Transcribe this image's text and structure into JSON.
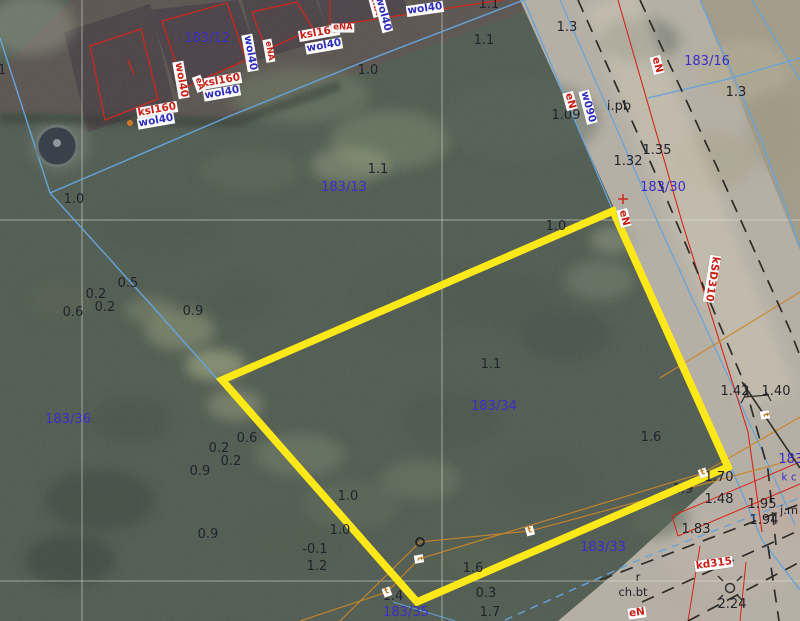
{
  "app": {
    "type": "cadastral-map-view"
  },
  "palette": {
    "num": "#22242c",
    "parcel": "#3a2ec8",
    "red": "#cc1f14",
    "blue": "#2d2ec0",
    "orange": "#c87820",
    "line_blue": "#66a3da",
    "line_red": "#d2261a",
    "line_orange": "#c8862a",
    "line_black": "#2e2c28",
    "grid": "#e3e6de",
    "highlight": "#ffe818"
  },
  "highlight_parcel": {
    "id": "183/34",
    "points": "613,211 222,380 417,602 728,467",
    "stroke_width": 7.5
  },
  "grid": {
    "v": [
      82,
      442
    ],
    "h": [
      220,
      581
    ]
  },
  "regions": [
    {
      "name": "pavement-top-left",
      "pts": "70,0 556,0 232,118 0,112 0,72",
      "fill": "#59534f"
    },
    {
      "name": "road-main",
      "pts": "520,0 700,0 800,250 800,621 558,621 616,572 731,467",
      "fill": "#b4aea4"
    },
    {
      "name": "parcel-183-16-surface",
      "pts": "700,0 800,0 800,250",
      "fill": "#a19a87"
    },
    {
      "name": "building-roof",
      "pts": "64,32 150,4 174,104 88,132",
      "fill": "#4a4145"
    },
    {
      "name": "building-roof",
      "pts": "150,10 238,0 258,56 176,92",
      "fill": "#494046"
    },
    {
      "name": "building-roof",
      "pts": "242,0 316,0 330,38 258,60",
      "fill": "#4a4145"
    },
    {
      "name": "building-roof",
      "pts": "318,0 404,0 410,14 326,28",
      "fill": "#4b4247"
    }
  ],
  "building_outlines": [
    {
      "name": "building-outline",
      "pts": "90,46 141,29 158,99 105,120"
    },
    {
      "name": "building-outline",
      "pts": "162,21 227,3 246,60 184,88"
    },
    {
      "name": "building-outline",
      "pts": "252,12 297,2 313,29 266,50"
    }
  ],
  "lines": [
    {
      "name": "water-line",
      "pts": "0,38 50,193",
      "c": "line_blue",
      "w": 1.4
    },
    {
      "name": "water-line",
      "pts": "50,193 153,307 218,380",
      "c": "line_blue",
      "w": 1.4
    },
    {
      "name": "water-line",
      "pts": "50,193 230,116 368,60 524,0",
      "c": "line_blue",
      "w": 1.4
    },
    {
      "name": "boundary-line-blue",
      "pts": "524,0 613,211 731,467 762,540 800,590",
      "c": "line_blue",
      "w": 1.3
    },
    {
      "name": "boundary-line-blue",
      "pts": "560,0 662,232 764,455 795,525",
      "c": "line_blue",
      "w": 1.2
    },
    {
      "name": "boundary-line-blue",
      "pts": "700,0 762,142 800,247",
      "c": "line_blue",
      "w": 1.3
    },
    {
      "name": "boundary-line-blue",
      "pts": "648,98 728,79 800,58",
      "c": "line_blue",
      "w": 1.2
    },
    {
      "name": "boundary-line-blue",
      "pts": "752,0 800,80",
      "c": "line_blue",
      "w": 1.2
    },
    {
      "name": "water-line-dashed",
      "pts": "505,620 648,556 800,498",
      "c": "line_blue",
      "w": 1.4,
      "dash": "8,6"
    },
    {
      "name": "boundary-line-blue",
      "pts": "393,602 455,621",
      "c": "line_blue",
      "w": 1
    },
    {
      "name": "power-line",
      "pts": "330,0 330,26",
      "c": "line_red",
      "w": 1.2
    },
    {
      "name": "power-line",
      "pts": "330,26 502,0",
      "c": "line_red",
      "w": 1.2
    },
    {
      "name": "power-line",
      "pts": "618,0 682,222 748,432 762,532",
      "c": "line_red",
      "w": 1.1
    },
    {
      "name": "red-outline",
      "pts": "672,516 800,462",
      "c": "line_red",
      "w": 1
    },
    {
      "name": "red-outline",
      "pts": "678,536 800,484",
      "c": "line_red",
      "w": 1
    },
    {
      "name": "red-outline",
      "pts": "672,516 678,536",
      "c": "line_red",
      "w": 1
    },
    {
      "name": "red-outline",
      "pts": "700,546 688,621",
      "c": "line_red",
      "w": 1
    },
    {
      "name": "red-outline",
      "pts": "746,562 740,621",
      "c": "line_red",
      "w": 1
    },
    {
      "name": "roof-mark",
      "pts": "128,60 134,74",
      "c": "line_red",
      "w": 1.3
    },
    {
      "name": "telecom-line",
      "pts": "340,621 420,542 530,531 800,458",
      "c": "line_orange",
      "w": 1.1
    },
    {
      "name": "telecom-line",
      "pts": "300,621 387,592 419,559 703,473 800,417",
      "c": "line_orange",
      "w": 1.1
    },
    {
      "name": "telecom-line",
      "pts": "660,378 800,292",
      "c": "line_orange",
      "w": 1.1
    },
    {
      "name": "road-edge-dashed",
      "pts": "578,0 665,195 745,385 768,470 776,545",
      "c": "line_black",
      "w": 1.7,
      "dash": "13,9"
    },
    {
      "name": "road-edge-dashed",
      "pts": "640,0 716,165 790,330 800,356",
      "c": "line_black",
      "w": 1.7,
      "dash": "13,9"
    },
    {
      "name": "road-edge-dashed",
      "pts": "600,580 800,504",
      "c": "line_black",
      "w": 1.7,
      "dash": "13,9"
    },
    {
      "name": "road-edge-dashed",
      "pts": "642,602 800,530",
      "c": "line_black",
      "w": 1.7,
      "dash": "13,9"
    },
    {
      "name": "road-edge-dashed",
      "pts": "688,621 800,562",
      "c": "line_black",
      "w": 1.7,
      "dash": "13,9"
    },
    {
      "name": "road-edge-dashed",
      "pts": "768,546 779,621",
      "c": "line_black",
      "w": 1.7,
      "dash": "13,9"
    },
    {
      "name": "boundary-line-black",
      "pts": "742,382 800,468",
      "c": "line_black",
      "w": 1.6
    },
    {
      "name": "dimension-tick",
      "pts": "741,403 747,392",
      "c": "line_black",
      "w": 1.2
    },
    {
      "name": "dimension-tick",
      "pts": "744,397 769,395",
      "c": "line_black",
      "w": 1.2
    },
    {
      "name": "dimension-tick",
      "pts": "765,390 771,401",
      "c": "line_black",
      "w": 1.2
    }
  ],
  "symbols": [
    {
      "type": "pond",
      "x": 57,
      "y": 146,
      "r": 20
    },
    {
      "type": "dot",
      "x": 130,
      "y": 123,
      "r": 3,
      "fill": "#d07828"
    },
    {
      "type": "open-circle",
      "x": 420,
      "y": 542,
      "r": 4
    },
    {
      "type": "manhole",
      "x": 730,
      "y": 588,
      "r": 4.5
    },
    {
      "type": "cross",
      "x": 623,
      "y": 199,
      "size": 5,
      "c": "#d2261a"
    }
  ],
  "parcel_labels": [
    {
      "t": "183/12",
      "x": 207,
      "y": 39
    },
    {
      "t": "183/13",
      "x": 344,
      "y": 188
    },
    {
      "t": "183/16",
      "x": 707,
      "y": 62
    },
    {
      "t": "183/30",
      "x": 663,
      "y": 188
    },
    {
      "t": "183/33",
      "x": 603,
      "y": 548
    },
    {
      "t": "183/34",
      "x": 494,
      "y": 407
    },
    {
      "t": "183/35",
      "x": 406,
      "y": 613
    },
    {
      "t": "183/36",
      "x": 68,
      "y": 420
    },
    {
      "t": "183/",
      "x": 793,
      "y": 460
    },
    {
      "t": "k c",
      "x": 789,
      "y": 478,
      "small": 1
    }
  ],
  "elevation_labels": [
    {
      "t": "1",
      "x": 2,
      "y": 71
    },
    {
      "t": "1.0",
      "x": 368,
      "y": 71
    },
    {
      "t": "1.1",
      "x": 484,
      "y": 41
    },
    {
      "t": "1.1",
      "x": 489,
      "y": 5
    },
    {
      "t": "1.3",
      "x": 567,
      "y": 28
    },
    {
      "t": "1.09",
      "x": 566,
      "y": 116
    },
    {
      "t": "i.pb",
      "x": 619,
      "y": 107
    },
    {
      "t": "1.32",
      "x": 628,
      "y": 162
    },
    {
      "t": "1.35",
      "x": 657,
      "y": 151
    },
    {
      "t": "1.3",
      "x": 736,
      "y": 93
    },
    {
      "t": "1.1",
      "x": 378,
      "y": 170
    },
    {
      "t": "1.0",
      "x": 74,
      "y": 200
    },
    {
      "t": "1.0",
      "x": 556,
      "y": 227
    },
    {
      "t": "0.5",
      "x": 128,
      "y": 284
    },
    {
      "t": "0.2",
      "x": 96,
      "y": 295
    },
    {
      "t": "0.2",
      "x": 105,
      "y": 308
    },
    {
      "t": "0.6",
      "x": 73,
      "y": 313
    },
    {
      "t": "0.9",
      "x": 193,
      "y": 312
    },
    {
      "t": "1.1",
      "x": 491,
      "y": 365
    },
    {
      "t": "1.6",
      "x": 651,
      "y": 438
    },
    {
      "t": "0.6",
      "x": 247,
      "y": 439
    },
    {
      "t": "0.2",
      "x": 219,
      "y": 449
    },
    {
      "t": "0.2",
      "x": 231,
      "y": 462
    },
    {
      "t": "0.9",
      "x": 200,
      "y": 472
    },
    {
      "t": "1.0",
      "x": 348,
      "y": 497
    },
    {
      "t": "1.0",
      "x": 340,
      "y": 531
    },
    {
      "t": "0.9",
      "x": 208,
      "y": 535
    },
    {
      "t": "-0.1",
      "x": 315,
      "y": 550
    },
    {
      "t": "1.2",
      "x": 317,
      "y": 567
    },
    {
      "t": "1.6",
      "x": 473,
      "y": 569
    },
    {
      "t": "0.3",
      "x": 486,
      "y": 594
    },
    {
      "t": "1.4",
      "x": 393,
      "y": 597
    },
    {
      "t": "1.7",
      "x": 490,
      "y": 613
    },
    {
      "t": "1.42",
      "x": 735,
      "y": 392
    },
    {
      "t": "1.40",
      "x": 776,
      "y": 392
    },
    {
      "t": "1.70",
      "x": 719,
      "y": 478
    },
    {
      "t": "1.9",
      "x": 683,
      "y": 489,
      "under": 1
    },
    {
      "t": "1.48",
      "x": 719,
      "y": 500
    },
    {
      "t": "1.95",
      "x": 762,
      "y": 505
    },
    {
      "t": "1.94",
      "x": 764,
      "y": 521
    },
    {
      "t": "1.83",
      "x": 696,
      "y": 530
    },
    {
      "t": "2.24",
      "x": 732,
      "y": 605
    },
    {
      "t": "r",
      "x": 638,
      "y": 577,
      "small": 1
    },
    {
      "t": "ch.bt",
      "x": 633,
      "y": 592,
      "small": 1
    },
    {
      "t": "j.m",
      "x": 789,
      "y": 510,
      "small": 1
    }
  ],
  "boxed_labels": [
    {
      "t": "ksl160",
      "x": 157,
      "y": 110,
      "r": -10,
      "c": "red"
    },
    {
      "t": "wol40",
      "x": 156,
      "y": 121,
      "r": -10,
      "c": "blue"
    },
    {
      "t": "ksl160",
      "x": 221,
      "y": 81,
      "r": -10,
      "c": "red"
    },
    {
      "t": "wol40",
      "x": 222,
      "y": 93,
      "r": -10,
      "c": "blue"
    },
    {
      "t": "ksl160",
      "x": 319,
      "y": 33,
      "r": -10,
      "c": "red"
    },
    {
      "t": "wol40",
      "x": 324,
      "y": 46,
      "r": -10,
      "c": "blue"
    },
    {
      "t": "wol40",
      "x": 425,
      "y": 9,
      "r": -8,
      "c": "blue"
    },
    {
      "t": "wol40",
      "x": 181,
      "y": 80,
      "r": 80,
      "c": "red"
    },
    {
      "t": "wol40",
      "x": 250,
      "y": 53,
      "r": 80,
      "c": "blue"
    },
    {
      "t": "eNA",
      "x": 269,
      "y": 51,
      "r": 80,
      "c": "red",
      "tiny": 1
    },
    {
      "t": "eA",
      "x": 199,
      "y": 84,
      "r": 70,
      "c": "red",
      "tiny": 1
    },
    {
      "t": "eNA",
      "x": 343,
      "y": 28,
      "r": 0,
      "c": "red",
      "tiny": 1
    },
    {
      "t": "eNA",
      "x": 375,
      "y": 6,
      "r": 75,
      "c": "red",
      "tiny": 1
    },
    {
      "t": "wol40",
      "x": 383,
      "y": 14,
      "r": 75,
      "c": "blue"
    },
    {
      "t": "eN",
      "x": 570,
      "y": 101,
      "r": 75,
      "c": "red"
    },
    {
      "t": "w090",
      "x": 588,
      "y": 107,
      "r": 75,
      "c": "blue"
    },
    {
      "t": "eN",
      "x": 657,
      "y": 65,
      "r": 75,
      "c": "red"
    },
    {
      "t": "eN",
      "x": 624,
      "y": 218,
      "r": 75,
      "c": "red"
    },
    {
      "t": "kSD310",
      "x": 712,
      "y": 279,
      "r": 99,
      "c": "red"
    },
    {
      "t": "kd315",
      "x": 714,
      "y": 564,
      "r": -8,
      "c": "red"
    },
    {
      "t": "eN",
      "x": 637,
      "y": 613,
      "r": -8,
      "c": "red"
    },
    {
      "t": "t",
      "x": 530,
      "y": 531,
      "r": -15,
      "c": "orange",
      "tiny": 1
    },
    {
      "t": "t",
      "x": 419,
      "y": 559,
      "r": 80,
      "c": "orange",
      "tiny": 1
    },
    {
      "t": "t",
      "x": 387,
      "y": 592,
      "r": -20,
      "c": "orange",
      "tiny": 1
    },
    {
      "t": "t",
      "x": 703,
      "y": 473,
      "r": -20,
      "c": "orange",
      "tiny": 1
    },
    {
      "t": "t",
      "x": 765,
      "y": 415,
      "r": 80,
      "c": "orange",
      "tiny": 1
    }
  ]
}
